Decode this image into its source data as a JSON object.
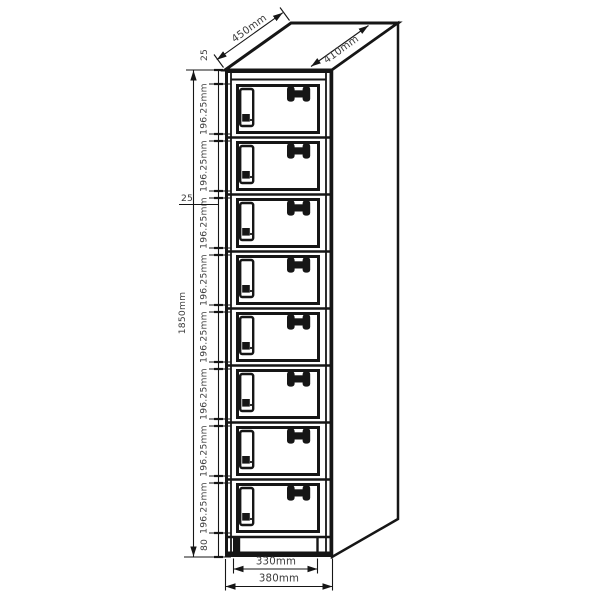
{
  "diagram": {
    "type": "technical-drawing",
    "subject": "8-door locker cabinet dimension drawing",
    "colors": {
      "line": "#161616",
      "text": "#3c3c3c",
      "background": "#ffffff"
    },
    "dimensions": {
      "top_depth": "450mm",
      "top_surface_depth": "410mm",
      "overall_height": "1850mm",
      "top_gap": "25",
      "door_gap": "25",
      "base_height": "80",
      "door_width": "330mm",
      "overall_width": "380mm",
      "compartments": [
        "196.25mm",
        "196.25mm",
        "196.25mm",
        "196.25mm",
        "196.25mm",
        "196.25mm",
        "196.25mm",
        "196.25mm"
      ]
    }
  }
}
